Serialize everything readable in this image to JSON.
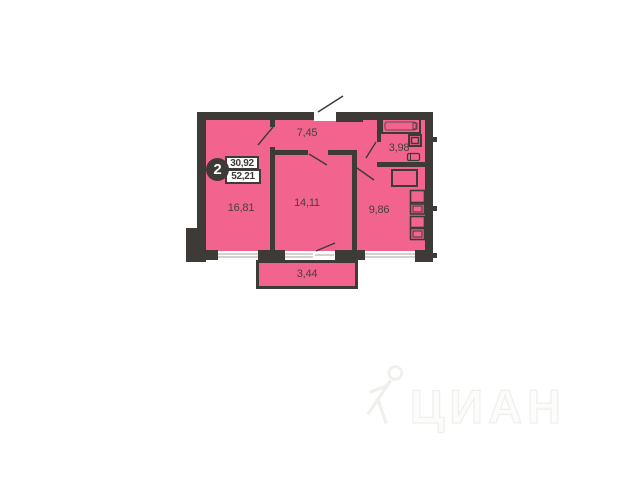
{
  "badge": {
    "rooms": "2",
    "living_area": "30,92",
    "total_area": "52,21"
  },
  "areas": {
    "hallway": "7,45",
    "bathroom": "3,98",
    "living_room": "16,81",
    "bedroom": "14,11",
    "kitchen": "9,86",
    "balcony": "3,44"
  },
  "watermark": {
    "brand": "ЦИАН"
  },
  "colors": {
    "room_fill": "#f2648d",
    "wall": "#3e3a38",
    "label_text": "#474140",
    "badge_bg": "#3e3a38",
    "badge_text": "#ffffff",
    "window_glass_line": "#aaa49e",
    "background": "#ffffff",
    "watermark": "#f0efec"
  }
}
